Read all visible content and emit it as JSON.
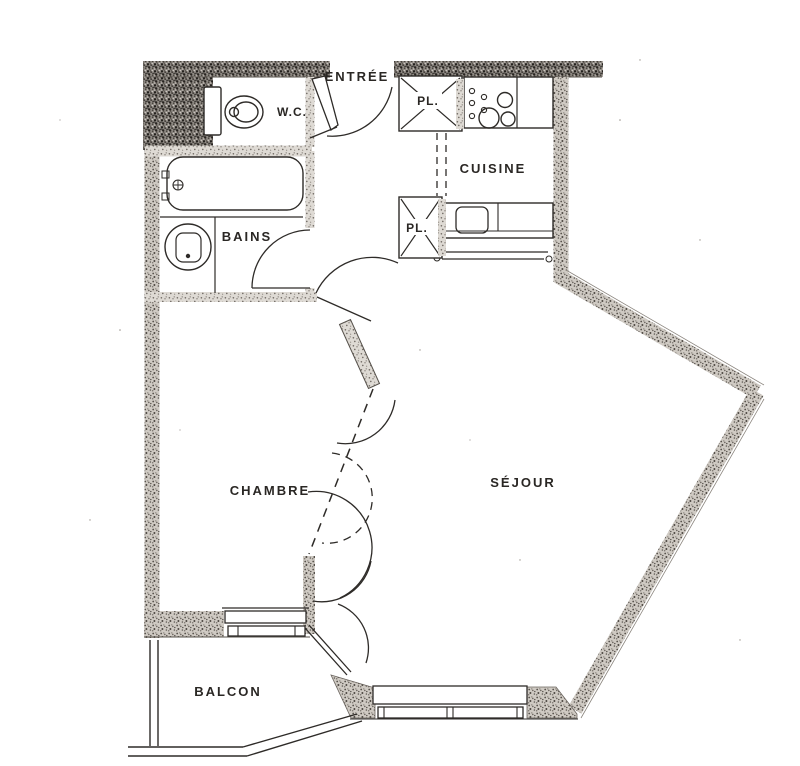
{
  "document": {
    "kind": "apartment-floor-plan"
  },
  "labels": {
    "entree": "ENTRÉE",
    "wc": "W.C.",
    "cuisine": "CUISINE",
    "pl_upper": "PL.",
    "pl_lower": "PL.",
    "bains": "BAINS",
    "chambre": "CHAMBRE",
    "sejour": "SÉJOUR",
    "balcon": "BALCON"
  },
  "colors": {
    "paper": "#ffffff",
    "ink": "#2e2b28",
    "wall_dark": "#8f8a84",
    "wall_medium": "#c9c4bd",
    "wall_light": "#dedad4"
  }
}
